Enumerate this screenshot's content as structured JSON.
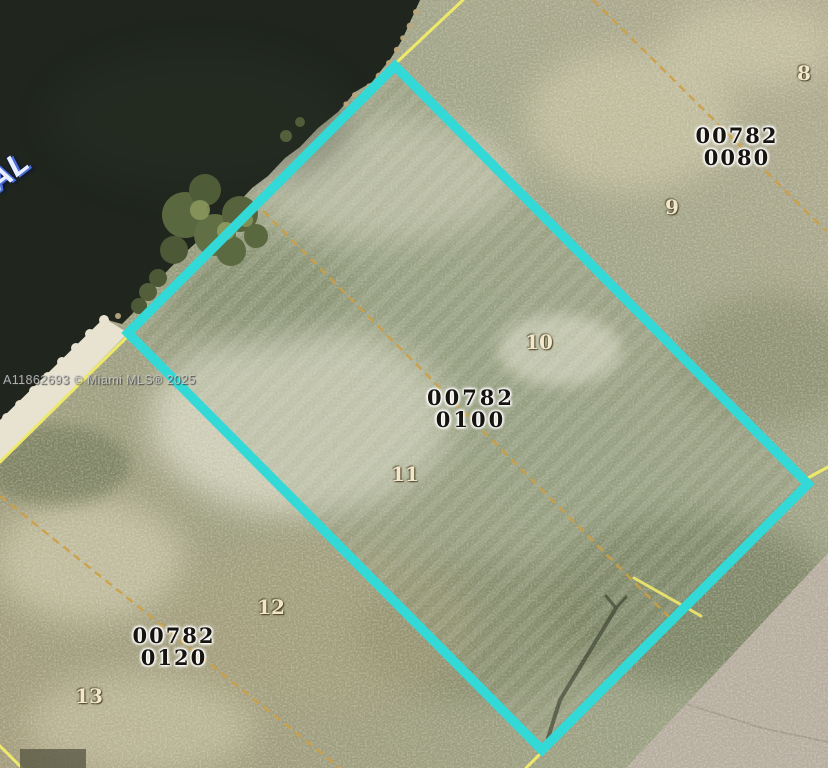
{
  "image_type": "aerial-parcel-map",
  "canal_label": "AL",
  "watermark": "A11862693 © Miami MLS® 2025",
  "parcels": [
    {
      "id_line1": "00782",
      "id_line2": "0080"
    },
    {
      "id_line1": "00782",
      "id_line2": "0100"
    },
    {
      "id_line1": "00782",
      "id_line2": "0120"
    }
  ],
  "lots": [
    {
      "number": "8"
    },
    {
      "number": "9"
    },
    {
      "number": "10"
    },
    {
      "number": "11"
    },
    {
      "number": "12"
    },
    {
      "number": "13"
    }
  ],
  "colors": {
    "highlight": "#33d9d6",
    "boundary": "#efe96a",
    "lotline": "#cd9f42",
    "water": "#20261e",
    "road": "#b7aea0"
  }
}
